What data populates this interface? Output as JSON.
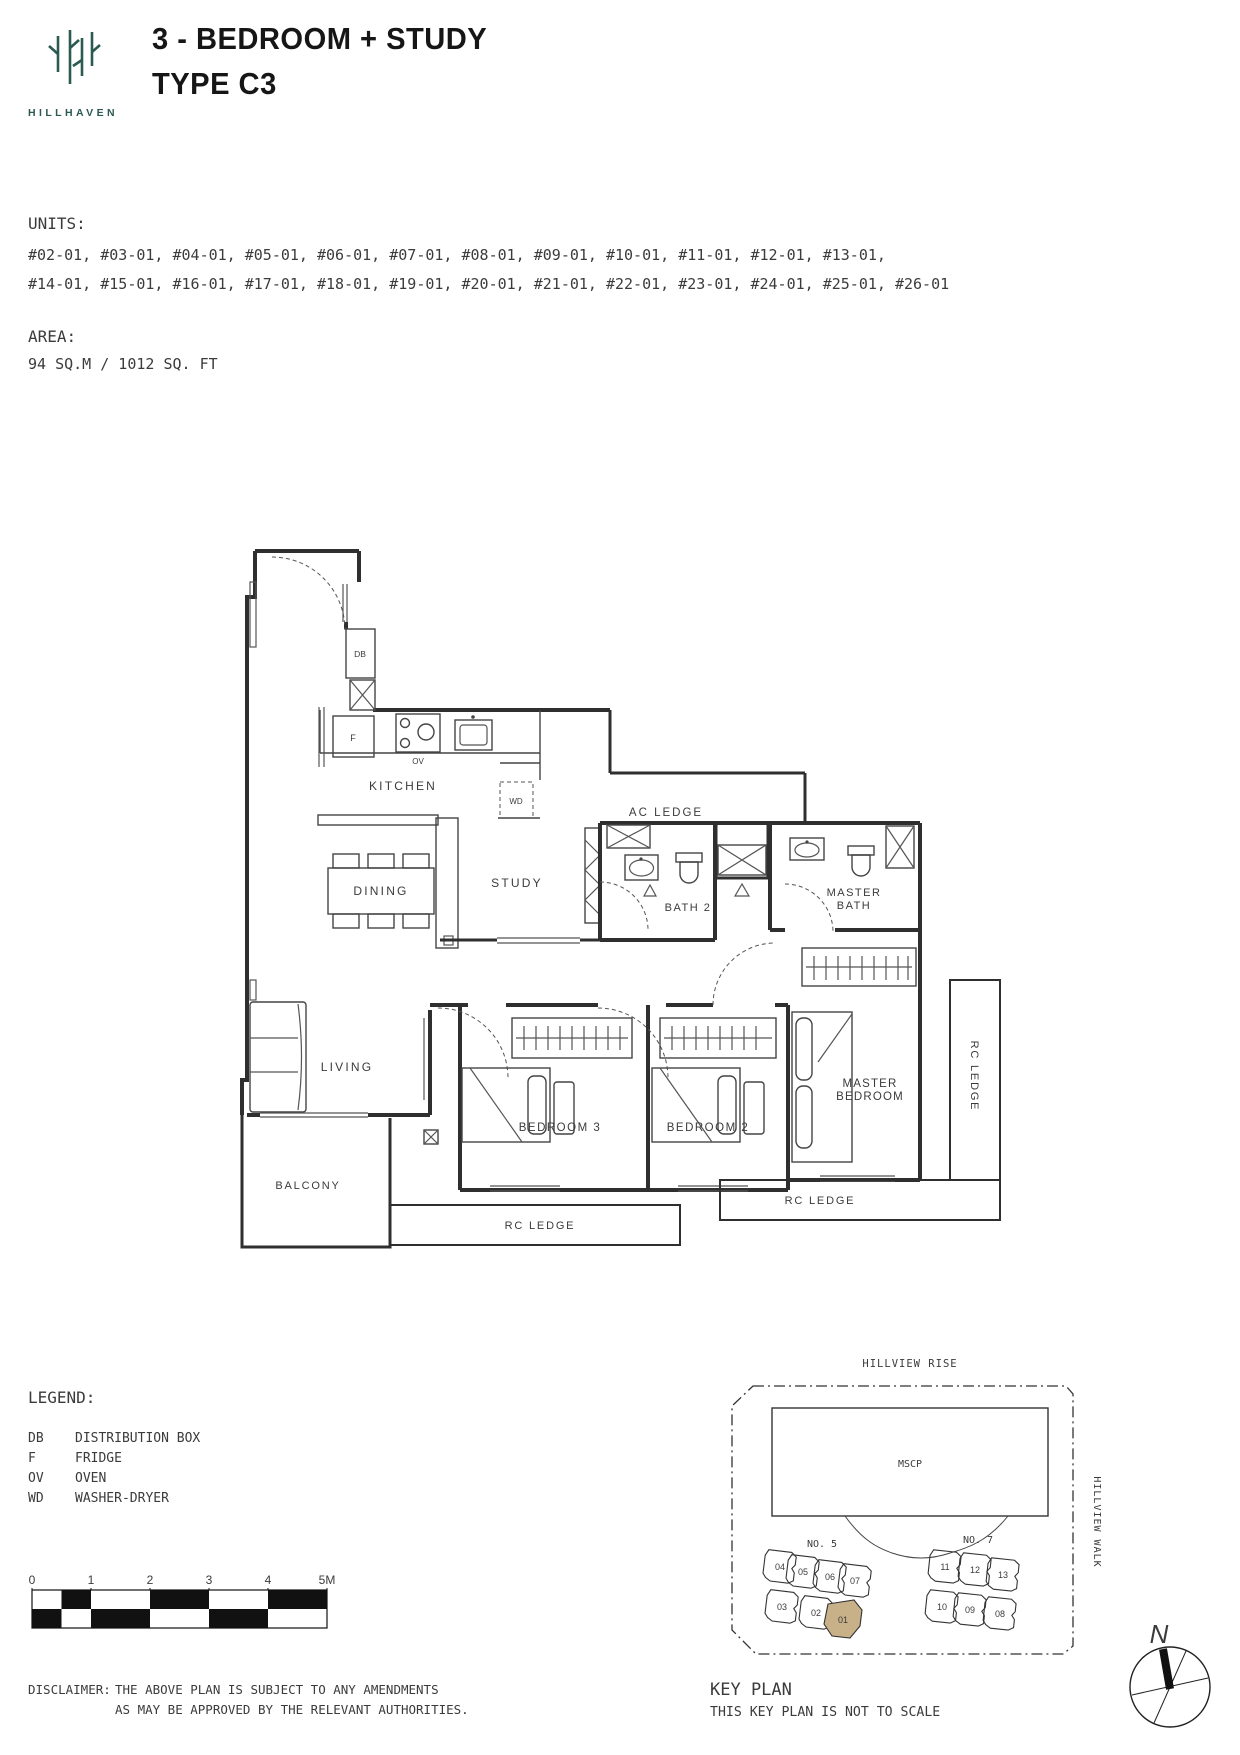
{
  "header": {
    "logo_text": "HILLHAVEN",
    "title_line1": "3 - BEDROOM + STUDY",
    "title_line2": "TYPE C3"
  },
  "units": {
    "label": "UNITS:",
    "line1": "#02-01, #03-01, #04-01, #05-01, #06-01, #07-01, #08-01, #09-01, #10-01, #11-01, #12-01, #13-01,",
    "line2": "#14-01, #15-01, #16-01, #17-01, #18-01, #19-01, #20-01, #21-01, #22-01, #23-01, #24-01, #25-01, #26-01"
  },
  "area": {
    "label": "AREA:",
    "value": "94 SQ.M / 1012 SQ. FT"
  },
  "floorplan": {
    "labels": {
      "kitchen": "KITCHEN",
      "dining": "DINING",
      "study": "STUDY",
      "living": "LIVING",
      "balcony": "BALCONY",
      "bedroom3": "BEDROOM 3",
      "bedroom2": "BEDROOM 2",
      "master_line1": "MASTER",
      "master_line2": "BEDROOM",
      "master_bath_line1": "MASTER",
      "master_bath_line2": "BATH",
      "bath2": "BATH 2",
      "ac_ledge": "AC LEDGE",
      "rc_ledge": "RC LEDGE",
      "db": "DB",
      "fridge": "F",
      "oven": "OV",
      "wd": "WD"
    }
  },
  "legend": {
    "label": "LEGEND:",
    "items": [
      {
        "code": "DB",
        "desc": "DISTRIBUTION BOX"
      },
      {
        "code": "F",
        "desc": "FRIDGE"
      },
      {
        "code": "OV",
        "desc": "OVEN"
      },
      {
        "code": "WD",
        "desc": "WASHER-DRYER"
      }
    ]
  },
  "scale_bar": {
    "ticks": [
      "0",
      "1",
      "2",
      "3",
      "4",
      "5M"
    ]
  },
  "disclaimer": {
    "label": "DISCLAIMER:",
    "line1": "THE ABOVE PLAN IS SUBJECT TO ANY AMENDMENTS",
    "line2": "AS MAY BE APPROVED BY THE RELEVANT AUTHORITIES."
  },
  "key_plan": {
    "title": "KEY PLAN",
    "subtitle": "THIS KEY PLAN IS NOT TO SCALE",
    "road_top": "HILLVIEW RISE",
    "road_right": "HILLVIEW WALK",
    "mscp": "MSCP",
    "north": "N",
    "highlight_color": "#c8b189",
    "cluster1": {
      "name": "NO. 5",
      "top": [
        "04",
        "05",
        "06",
        "07"
      ],
      "bottom": [
        "03",
        "02",
        "01"
      ]
    },
    "cluster2": {
      "name": "NO. 7",
      "top": [
        "11",
        "12",
        "13"
      ],
      "bottom": [
        "10",
        "09",
        "08"
      ]
    }
  }
}
